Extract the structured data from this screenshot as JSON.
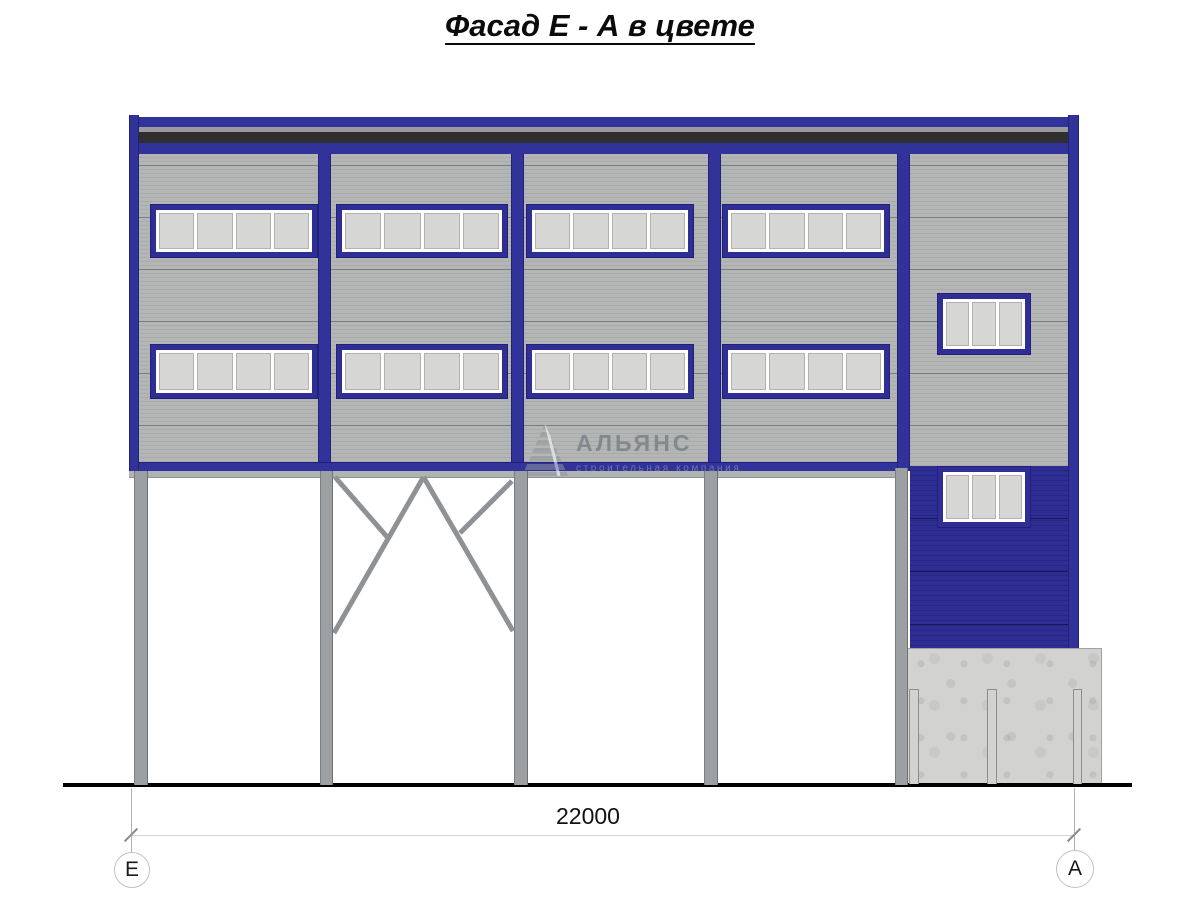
{
  "title": {
    "text": "Фасад Е - А в цвете"
  },
  "watermark": {
    "name": "АЛЬЯНС",
    "subtitle": "строительная компания"
  },
  "dimension": {
    "value": "22000"
  },
  "axes": {
    "left": "Е",
    "right": "А"
  },
  "colors": {
    "facade_blue": "#32329b",
    "frame_blue": "#2e2e94",
    "cladding_gray": "#b1b4b3",
    "cladding_blue": "#2b2b8f",
    "parapet_dark": "#2f2f31",
    "parapet_gray": "#9b9b9b",
    "column_gray": "#9ca0a2",
    "concrete_gray": "#d2d2d0",
    "pane_gray": "#d6d6d4",
    "ground_black": "#000000"
  },
  "drawing": {
    "windows": [
      {
        "name": "window-bay1-upper",
        "x": 151,
        "y": 205,
        "w": 166,
        "h": 52,
        "panes": 4
      },
      {
        "name": "window-bay2-upper",
        "x": 337,
        "y": 205,
        "w": 170,
        "h": 52,
        "panes": 4
      },
      {
        "name": "window-bay3-upper",
        "x": 527,
        "y": 205,
        "w": 166,
        "h": 52,
        "panes": 4
      },
      {
        "name": "window-bay4-upper",
        "x": 723,
        "y": 205,
        "w": 166,
        "h": 52,
        "panes": 4
      },
      {
        "name": "window-bay1-lower",
        "x": 151,
        "y": 345,
        "w": 166,
        "h": 53,
        "panes": 4
      },
      {
        "name": "window-bay2-lower",
        "x": 337,
        "y": 345,
        "w": 170,
        "h": 53,
        "panes": 4
      },
      {
        "name": "window-bay3-lower",
        "x": 527,
        "y": 345,
        "w": 166,
        "h": 53,
        "panes": 4
      },
      {
        "name": "window-bay4-lower",
        "x": 723,
        "y": 345,
        "w": 166,
        "h": 53,
        "panes": 4
      },
      {
        "name": "window-right-upper",
        "x": 938,
        "y": 294,
        "w": 92,
        "h": 60,
        "panes": 3
      },
      {
        "name": "window-right-lower",
        "x": 938,
        "y": 467,
        "w": 92,
        "h": 60,
        "panes": 3
      }
    ],
    "pilasters": [
      {
        "name": "pilaster-left",
        "x": 129,
        "y": 115,
        "w": 10,
        "h": 356
      },
      {
        "name": "pilaster-1",
        "x": 318,
        "y": 154,
        "w": 13,
        "h": 308
      },
      {
        "name": "pilaster-2",
        "x": 511,
        "y": 154,
        "w": 13,
        "h": 308
      },
      {
        "name": "pilaster-3",
        "x": 708,
        "y": 154,
        "w": 13,
        "h": 308
      },
      {
        "name": "pilaster-4",
        "x": 897,
        "y": 154,
        "w": 13,
        "h": 317
      },
      {
        "name": "pilaster-right",
        "x": 1068,
        "y": 115,
        "w": 11,
        "h": 533
      }
    ],
    "columns": [
      {
        "name": "column-1",
        "x": 134,
        "y": 471,
        "w": 14,
        "h": 314
      },
      {
        "name": "column-2",
        "x": 320,
        "y": 471,
        "w": 13,
        "h": 314
      },
      {
        "name": "column-3",
        "x": 514,
        "y": 471,
        "w": 14,
        "h": 314
      },
      {
        "name": "column-4",
        "x": 704,
        "y": 471,
        "w": 14,
        "h": 314
      },
      {
        "name": "column-5",
        "x": 895,
        "y": 468,
        "w": 13,
        "h": 317
      }
    ],
    "bracing": [
      {
        "x1": 423.5,
        "y1": 477,
        "x2": 334,
        "y2": 633
      },
      {
        "x1": 423.5,
        "y1": 477,
        "x2": 513,
        "y2": 631
      },
      {
        "x1": 335,
        "y1": 477,
        "x2": 388,
        "y2": 538
      },
      {
        "x1": 512,
        "y1": 481,
        "x2": 460,
        "y2": 533
      }
    ],
    "foundation_posts": [
      {
        "name": "foundation-post-1",
        "x": 909,
        "y": 689,
        "w": 10,
        "h": 95
      },
      {
        "name": "foundation-post-2",
        "x": 987,
        "y": 689,
        "w": 10,
        "h": 95
      },
      {
        "name": "foundation-post-3",
        "x": 1073,
        "y": 689,
        "w": 9,
        "h": 95
      }
    ]
  }
}
